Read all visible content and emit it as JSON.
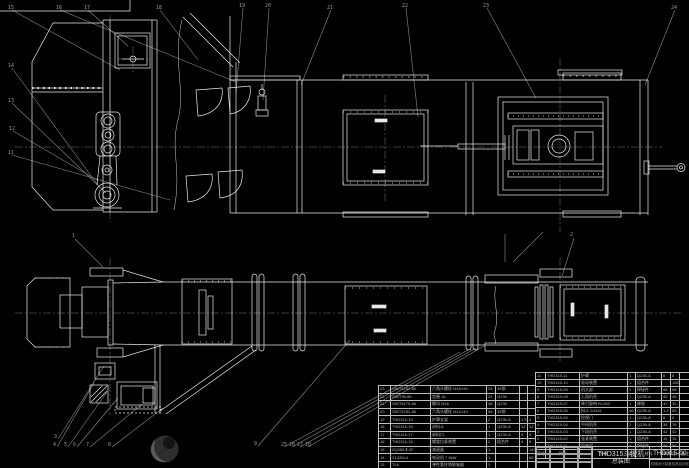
{
  "drawing": {
    "product": "THD315斗提机",
    "sheet_title": "总装图",
    "drawing_no": "THD315-00",
    "org": "机械设计制造及其自动化"
  },
  "bom_header": {
    "seq": "序号",
    "code": "代号",
    "name": "名称",
    "qty": "数量",
    "material": "材料",
    "unit_weight": "单件",
    "total_weight": "总计",
    "notes": "备注"
  },
  "bom_right": {
    "rows": [
      {
        "seq": "11",
        "code": "THD315-11",
        "name": "护罩",
        "qty": "1",
        "material": "Q235-A",
        "w1": "8",
        "w2": "8",
        "notes": ""
      },
      {
        "seq": "10",
        "code": "THD315-10",
        "name": "驱动装置",
        "qty": "1",
        "material": "组合件",
        "w1": "",
        "w2": "156",
        "notes": ""
      },
      {
        "seq": "9",
        "code": "THD315-09",
        "name": "机头部",
        "qty": "1",
        "material": "焊接件",
        "w1": "98",
        "w2": "98",
        "notes": ""
      },
      {
        "seq": "8",
        "code": "THD315-08",
        "name": "上段机壳",
        "qty": "1",
        "material": "Q235-A",
        "w1": "45",
        "w2": "45",
        "notes": ""
      },
      {
        "seq": "7",
        "code": "THD315-07",
        "name": "牵引胶带 B=250",
        "qty": "1",
        "material": "橡胶",
        "w1": "32",
        "w2": "32",
        "notes": ""
      },
      {
        "seq": "6",
        "code": "THD315-06",
        "name": "料斗 Zd315",
        "qty": "46",
        "material": "Q235-A",
        "w1": "1.2",
        "w2": "55",
        "notes": ""
      },
      {
        "seq": "5",
        "code": "THD315-05",
        "name": "检视门",
        "qty": "1",
        "material": "Q235-A",
        "w1": "6",
        "w2": "6",
        "notes": ""
      },
      {
        "seq": "4",
        "code": "THD315-04",
        "name": "中间机壳",
        "qty": "2",
        "material": "Q235-A",
        "w1": "38",
        "w2": "76",
        "notes": ""
      },
      {
        "seq": "3",
        "code": "THD315-03",
        "name": "下段机壳",
        "qty": "1",
        "material": "Q235-A",
        "w1": "42",
        "w2": "42",
        "notes": ""
      },
      {
        "seq": "2",
        "code": "THD315-02",
        "name": "张紧装置",
        "qty": "1",
        "material": "组合件",
        "w1": "15",
        "w2": "15",
        "notes": ""
      },
      {
        "seq": "1",
        "code": "THD315-01",
        "name": "机座部",
        "qty": "1",
        "material": "焊接件",
        "w1": "86",
        "w2": "86",
        "notes": ""
      }
    ]
  },
  "bom_left": {
    "rows": [
      {
        "seq": "23",
        "code": "GB/T5782-86",
        "name": "六角头螺栓 M16×50",
        "qty": "24",
        "material": "35钢",
        "w1": "",
        "w2": ""
      },
      {
        "seq": "22",
        "code": "GB/T95-85",
        "name": "垫圈 16",
        "qty": "24",
        "material": "Q235",
        "w1": "",
        "w2": ""
      },
      {
        "seq": "21",
        "code": "GB/T6170-86",
        "name": "螺母 M16",
        "qty": "48",
        "material": "Q235",
        "w1": "",
        "w2": ""
      },
      {
        "seq": "20",
        "code": "GB/T5782-86",
        "name": "六角头螺栓 M12×40",
        "qty": "56",
        "material": "35钢",
        "w1": "",
        "w2": ""
      },
      {
        "seq": "19",
        "code": "THD315-19",
        "name": "护罩支架",
        "qty": "2",
        "material": "Q235-A",
        "w1": "1.5",
        "w2": "3"
      },
      {
        "seq": "18",
        "code": "THD315-18",
        "name": "进料斗",
        "qty": "1",
        "material": "Q235-A",
        "w1": "12",
        "w2": "12"
      },
      {
        "seq": "17",
        "code": "THD315-17",
        "name": "卸料口",
        "qty": "1",
        "material": "Q235-A",
        "w1": "9",
        "w2": "9"
      },
      {
        "seq": "16",
        "code": "THD315-16",
        "name": "螺旋拉紧装置",
        "qty": "2",
        "material": "组合件",
        "w1": "4",
        "w2": "8"
      },
      {
        "seq": "15",
        "code": "ZQ350-Ⅱ-2F",
        "name": "减速器",
        "qty": "1",
        "material": "",
        "w1": "",
        "w2": "140"
      },
      {
        "seq": "14",
        "code": "Y132M-4",
        "name": "电动机 7.5kW",
        "qty": "1",
        "material": "",
        "w1": "",
        "w2": "68"
      },
      {
        "seq": "13",
        "code": "TL6",
        "name": "弹性套柱销联轴器",
        "qty": "1",
        "material": "",
        "w1": "",
        "w2": ""
      },
      {
        "seq": "12",
        "code": "THD315-12",
        "name": "底座",
        "qty": "1",
        "material": "Q235-A",
        "w1": "",
        "w2": ""
      }
    ]
  },
  "callouts": [
    "15",
    "16",
    "17",
    "18",
    "19",
    "20",
    "21",
    "22",
    "23",
    "24",
    "14",
    "13",
    "12",
    "11",
    "1",
    "2",
    "3",
    "4",
    "5",
    "6",
    "7",
    "8",
    "9",
    "25",
    "26",
    "27",
    "28"
  ],
  "colors": {
    "background": "#000000",
    "geometry_line": "#e8e8e8",
    "aux_line": "#8a8a8a",
    "table_line": "#bdbdbd",
    "table_text": "#b5b5b5"
  }
}
